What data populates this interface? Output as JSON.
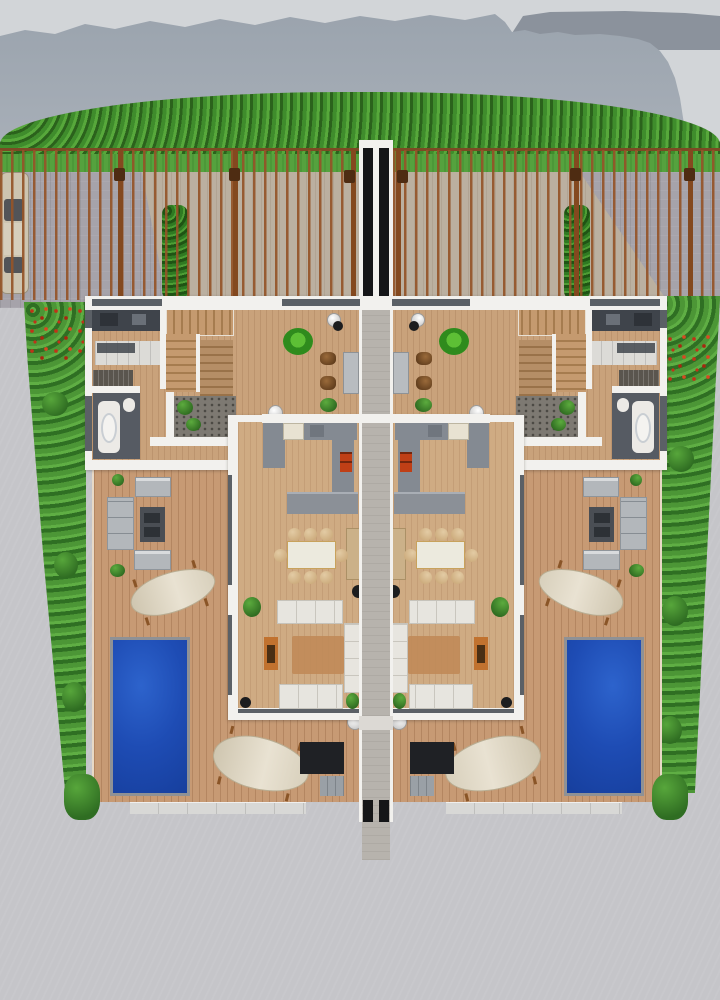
{
  "meta": {
    "description": "Aerial 3D architectural rendering of a mirrored twin (duplex) villa floor plan with front driveway, slatted fence, central walkway, wooden deck terraces, two swimming pools and side gardens against a mountain backdrop",
    "units": 2,
    "pools": 2,
    "staircases": 2,
    "sun_loungers_per_unit": 2,
    "dining_seats_per_unit": 8
  },
  "colors": {
    "sky": "#d2d5d8",
    "mountain": "#9aa3ad",
    "mountainFar": "#8b929c",
    "bushRow": "#3f8c2c",
    "grass": "#55a23e",
    "hedge": "#2f7a22",
    "garden": "#4c9636",
    "flower": "#c03318",
    "paveFront": "#a6a3aa",
    "paveTan": "#bbb0a0",
    "paveBottom": "#c5c5c9",
    "fence": "#7c4a24",
    "fenceDark": "#84491f",
    "carBody": "#cdc4b0",
    "carGlass": "#3c4149",
    "wall": "#f2f1ee",
    "glass": "#41464d",
    "wood": "#c9a27b",
    "deck": "#c79a74",
    "stair": "#c59a6f",
    "gravel": "#7d7972",
    "counterDark": "#3f444b",
    "cabinet": "#dcdbd7",
    "counterGray": "#848a92",
    "island": "#8b9097",
    "fridge": "#e8e2d2",
    "stove": "#bf3f16",
    "bathFloor": "#565b63",
    "rugTan": "#c08a58",
    "sideboard": "#c1722f",
    "outSofa": "#b3b7bb",
    "outTable": "#4a4e54",
    "pool": "#1e4cb4",
    "poolLight": "#2d63cc",
    "walkDark": "#151618",
    "walkPath": "#b7b3ad",
    "steps": "#d8d8d6"
  },
  "scene": {
    "background": [
      "sky",
      "mountain-ridge",
      "tree-hedgerow",
      "slatted-fence",
      "driveway-paving",
      "parked-car"
    ],
    "unit_rooms": [
      "kitchen",
      "bathroom",
      "staircase",
      "study-area",
      "gravel-patio",
      "open-living-dining",
      "kitchen-island",
      "terrace-deck",
      "swimming-pool"
    ],
    "unit_furniture": [
      "dining-table",
      "dining-chairs",
      "indoor-sofas",
      "area-rug",
      "sideboard",
      "floor-lamp",
      "outdoor-sofa-set",
      "fire-table",
      "sun-loungers",
      "tv-bench",
      "ball-lamps",
      "potted-plants"
    ]
  }
}
